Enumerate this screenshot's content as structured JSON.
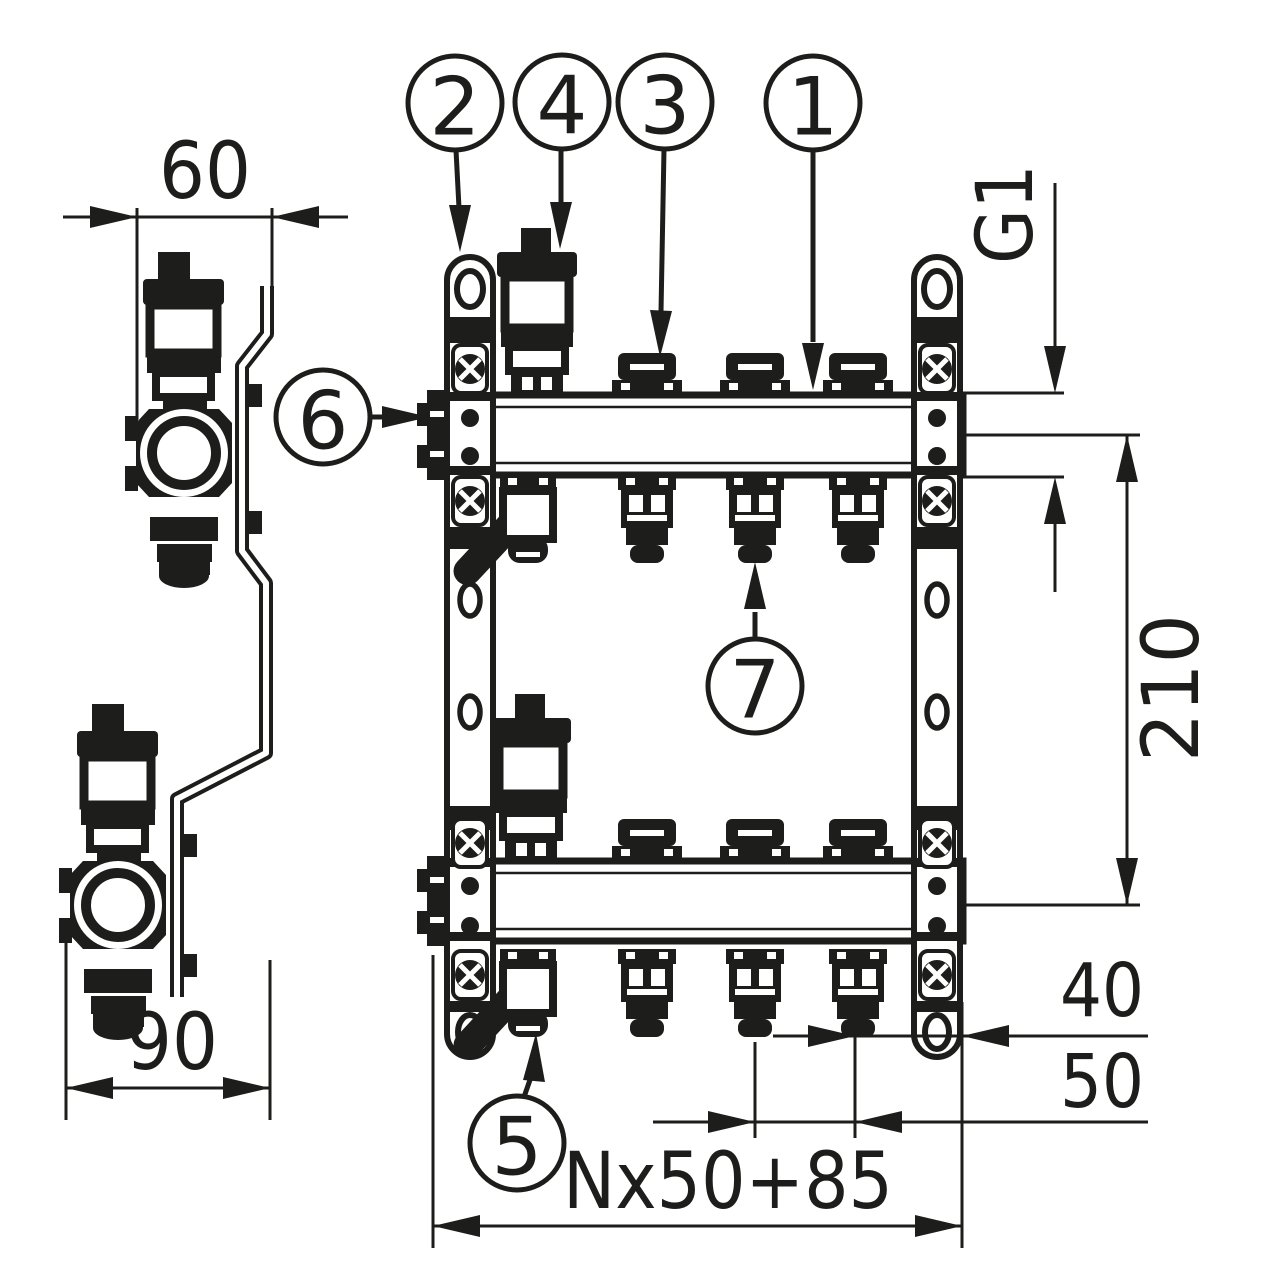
{
  "page": {
    "background": "#ffffff"
  },
  "drawing": {
    "ink_color": "#1d1d1b",
    "callouts": {
      "c1": "1",
      "c2": "2",
      "c3": "3",
      "c4": "4",
      "c5": "5",
      "c6": "6",
      "c7": "7"
    },
    "dimensions": {
      "bracket_width": "60",
      "bracket_depth": "90",
      "main_connection": "G1",
      "bar_axis_spacing": "210",
      "last_outlet_to_edge": "40",
      "outlet_spacing": "50",
      "total_length": "Nx50+85"
    }
  }
}
